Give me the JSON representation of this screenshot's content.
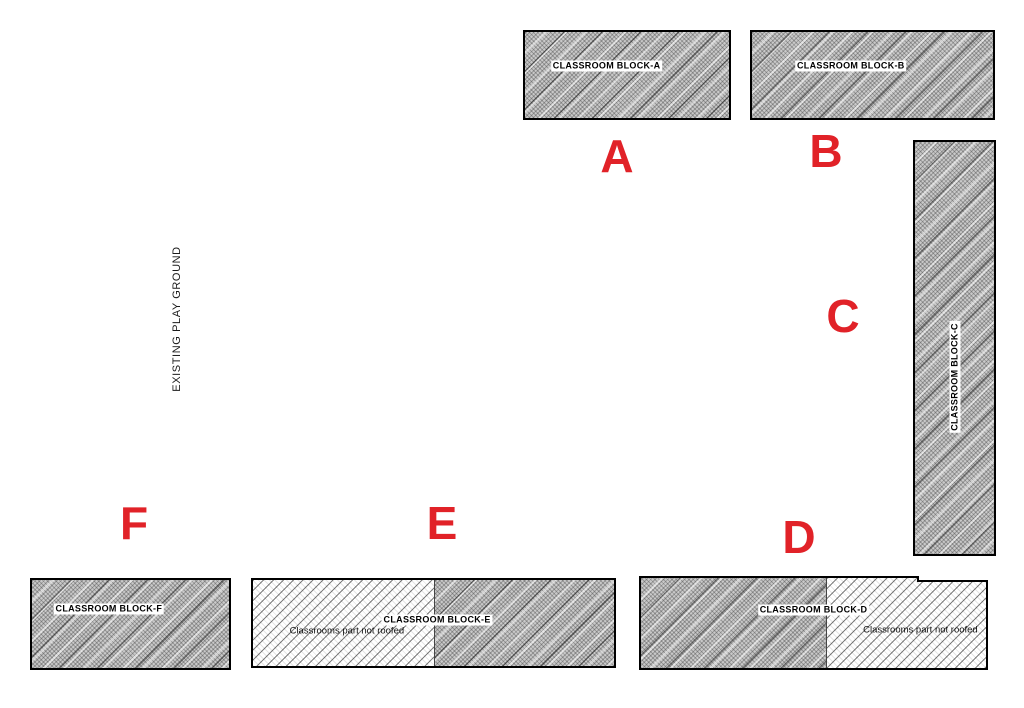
{
  "colors": {
    "marker_red": "#e12228",
    "outline": "#000000"
  },
  "playground": {
    "label": "EXISTING PLAY GROUND"
  },
  "blocks": {
    "a": {
      "marker": "A",
      "label": "CLASSROOM BLOCK-A"
    },
    "b": {
      "marker": "B",
      "label": "CLASSROOM BLOCK-B"
    },
    "c": {
      "marker": "C",
      "label": "CLASSROOM BLOCK-C"
    },
    "d": {
      "marker": "D",
      "label": "CLASSROOM BLOCK-D",
      "note": "Classrooms part not roofed"
    },
    "e": {
      "marker": "E",
      "label": "CLASSROOM BLOCK-E",
      "note": "Classrooms part not roofed"
    },
    "f": {
      "marker": "F",
      "label": "CLASSROOM BLOCK-F"
    }
  }
}
